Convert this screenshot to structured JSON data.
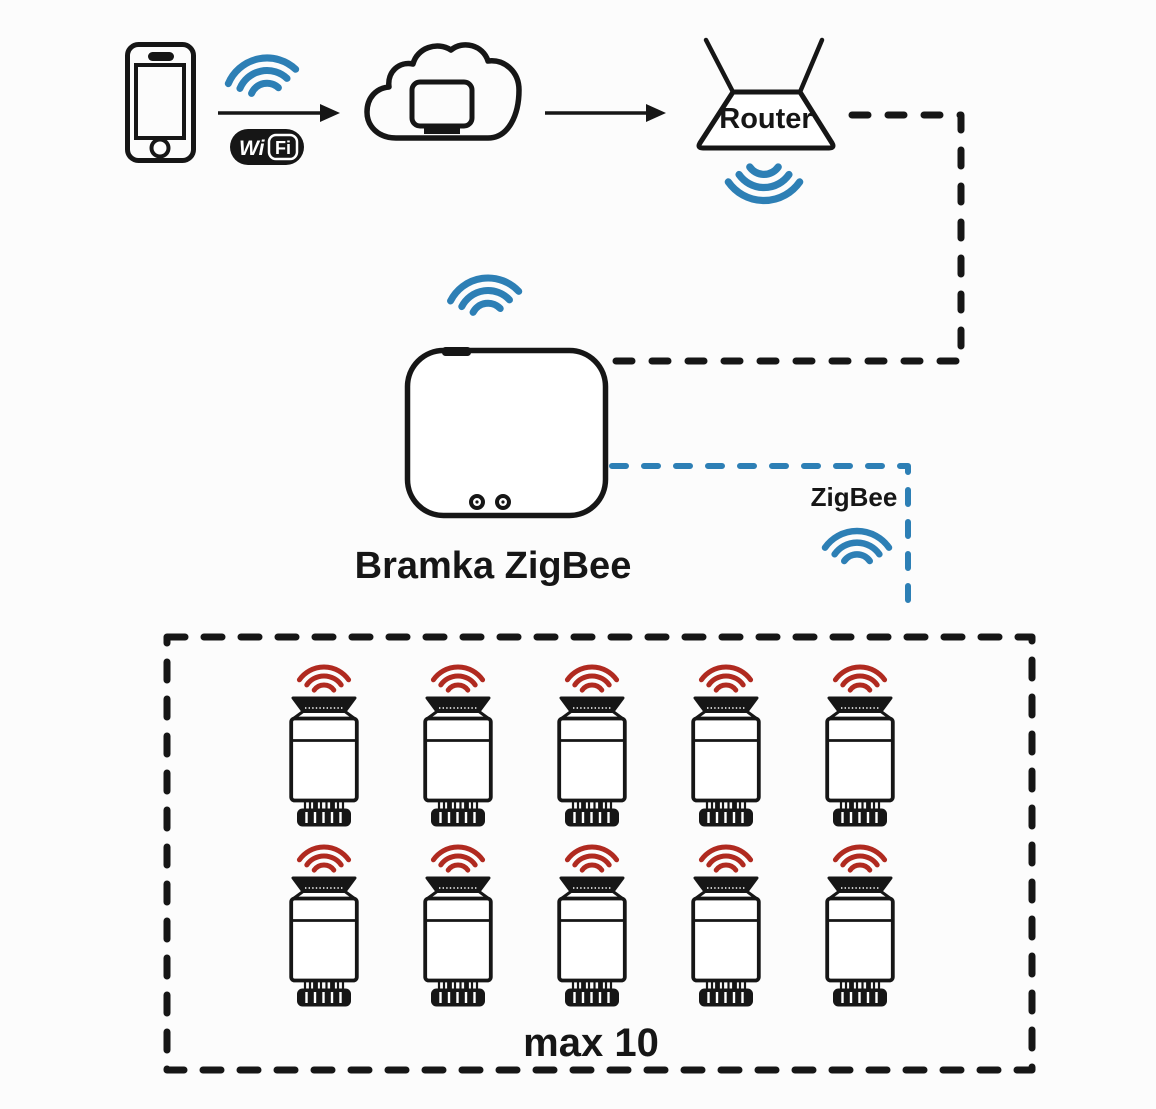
{
  "colors": {
    "background": "#fcfcfc",
    "ink": "#161616",
    "blue": "#2d7fb5",
    "red": "#b02a20"
  },
  "phone": {
    "icon": "smartphone-icon"
  },
  "phone_link": {
    "wifi_icon": "wifi-signal-icon",
    "badge": {
      "wi": "Wi",
      "fi": "Fi"
    }
  },
  "cloud": {
    "icon": "cloud-server-icon"
  },
  "router": {
    "label": "Router",
    "wifi_icon": "wifi-signal-icon"
  },
  "gateway": {
    "label": "Bramka ZigBee",
    "wifi_icon": "wifi-signal-icon"
  },
  "zigbee_link": {
    "label": "ZigBee",
    "wifi_icon": "zigbee-signal-icon"
  },
  "valve_group": {
    "label": "max 10",
    "count": 10,
    "device": "radiator-thermostat-valve",
    "rows": [
      658,
      838
    ],
    "columns": [
      288,
      422,
      556,
      690,
      824
    ]
  }
}
